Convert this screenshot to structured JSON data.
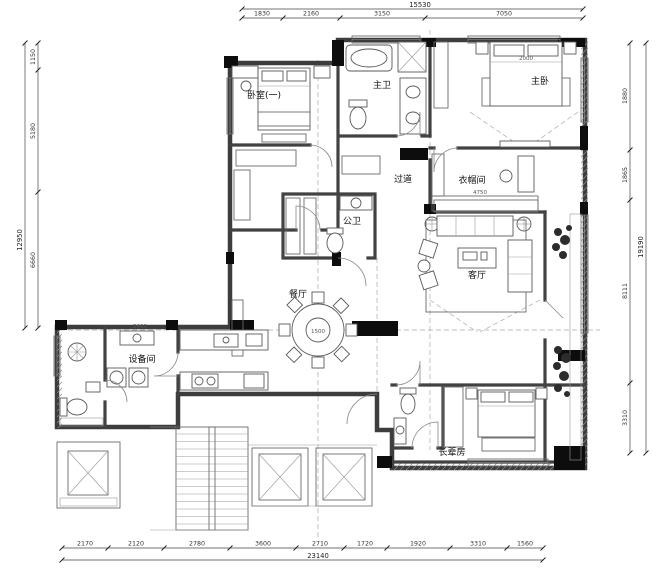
{
  "drawing": {
    "title": "residential-floor-plan",
    "rooms": {
      "bedroom1": "卧室(一)",
      "master_bath": "主卫",
      "master_bedroom": "主卧",
      "cloakroom": "衣帽间",
      "corridor": "过道",
      "guest_bath": "公卫",
      "living": "客厅",
      "dining": "餐厅",
      "equipment": "设备间",
      "elder_room": "长辈房"
    },
    "dims": {
      "top": {
        "total": "15530",
        "segments": [
          "1830",
          "2160",
          "3150",
          "7050"
        ]
      },
      "left": {
        "total": "12950",
        "segments": [
          "1150",
          "5180",
          "6660"
        ]
      },
      "right": {
        "total": "19190",
        "segments": [
          "1880",
          "1865",
          "8111",
          "3310"
        ]
      },
      "bottom": {
        "total": "23140",
        "segments": [
          "2170",
          "2120",
          "2780",
          "3600",
          "2710",
          "1720",
          "1920",
          "3310",
          "1560"
        ]
      }
    },
    "interior_dims": {
      "dining_table": "1500",
      "master_bed": "2000",
      "cloakroom_width": "4750",
      "equipment_width": "2400"
    },
    "colors": {
      "wall": "#3d3d3d",
      "column": "#0d0d0d",
      "background": "#ffffff",
      "hatch": "#888888"
    }
  }
}
